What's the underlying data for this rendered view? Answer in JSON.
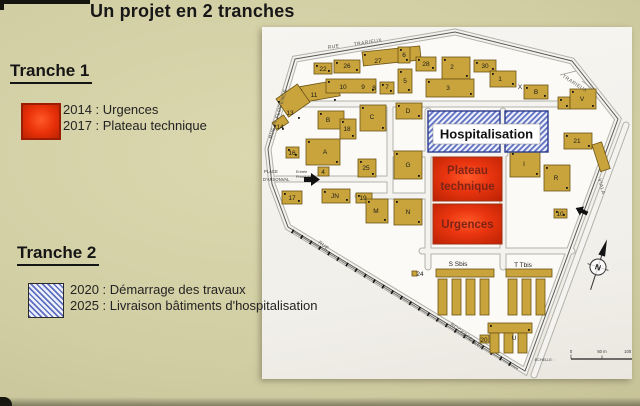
{
  "title": "Un projet en 2 tranches",
  "tranche1": {
    "heading": "Tranche 1",
    "items": [
      "2014 : Urgences",
      "2017 : Plateau technique"
    ]
  },
  "tranche2": {
    "heading": "Tranche 2",
    "items": [
      "2020 : Démarrage des travaux",
      "2025 : Livraison bâtiments d'hospitalisation"
    ]
  },
  "colors": {
    "phase1_red": "#e83008",
    "phase2_hatch_blue": "#5d6fc0",
    "building_gold": "#c9a33b",
    "board_khaki": "#d2cea4",
    "sheet_white": "#f3f2ee"
  },
  "map": {
    "zones": {
      "hospitalisation": "Hospitalisation",
      "plateau_line1": "Plateau",
      "plateau_line2": "technique",
      "urgences": "Urgences"
    },
    "place": {
      "line1": "PLACE",
      "line2": "D'ARSONVAL"
    },
    "entrance": {
      "line1": "Entrée",
      "line2": "Principale"
    },
    "compass_letter": "N",
    "scale": {
      "label": "ECHELLE :",
      "ticks": [
        "0",
        "50 m",
        "100 m"
      ]
    },
    "streets": [
      {
        "t": "RUE",
        "x": 66,
        "y": 22,
        "r": -9
      },
      {
        "t": "TRARIEUX",
        "x": 92,
        "y": 19,
        "r": -9
      },
      {
        "t": "TRARIEUX",
        "x": 300,
        "y": 50,
        "r": 33
      },
      {
        "t": "RUE Pr FLORENCE",
        "x": 10,
        "y": 112,
        "r": -73
      },
      {
        "t": "ROCKEFELLER",
        "x": 188,
        "y": 298,
        "r": 38
      },
      {
        "t": "RUE",
        "x": 56,
        "y": 216,
        "r": 38
      },
      {
        "t": "VIALA",
        "x": 336,
        "y": 152,
        "r": 75
      }
    ],
    "building_labels": [
      {
        "t": "22",
        "x": 61,
        "y": 44
      },
      {
        "t": "26",
        "x": 85,
        "y": 41
      },
      {
        "t": "27",
        "x": 116,
        "y": 36
      },
      {
        "t": "6",
        "x": 142,
        "y": 30
      },
      {
        "t": "28",
        "x": 164,
        "y": 39
      },
      {
        "t": "2",
        "x": 190,
        "y": 42
      },
      {
        "t": "30",
        "x": 223,
        "y": 41
      },
      {
        "t": "1",
        "x": 238,
        "y": 54
      },
      {
        "t": "X",
        "x": 258,
        "y": 62
      },
      {
        "t": "B",
        "x": 274,
        "y": 67
      },
      {
        "t": "3",
        "x": 186,
        "y": 63
      },
      {
        "t": "5",
        "x": 143,
        "y": 56
      },
      {
        "t": "7",
        "x": 125,
        "y": 62
      },
      {
        "t": "8",
        "x": 112,
        "y": 63
      },
      {
        "t": "9",
        "x": 101,
        "y": 62
      },
      {
        "t": "10",
        "x": 81,
        "y": 62
      },
      {
        "t": "11",
        "x": 52,
        "y": 70
      },
      {
        "t": "13",
        "x": 28,
        "y": 88
      },
      {
        "t": "14",
        "x": 18,
        "y": 102
      },
      {
        "t": "B",
        "x": 66,
        "y": 95
      },
      {
        "t": "18",
        "x": 85,
        "y": 104
      },
      {
        "t": "C",
        "x": 110,
        "y": 92
      },
      {
        "t": "D",
        "x": 146,
        "y": 86
      },
      {
        "t": "16",
        "x": 30,
        "y": 128
      },
      {
        "t": "A",
        "x": 63,
        "y": 127
      },
      {
        "t": "4",
        "x": 61,
        "y": 147
      },
      {
        "t": "25",
        "x": 104,
        "y": 143
      },
      {
        "t": "17",
        "x": 30,
        "y": 173
      },
      {
        "t": "JN",
        "x": 73,
        "y": 171
      },
      {
        "t": "19",
        "x": 101,
        "y": 173
      },
      {
        "t": "G",
        "x": 146,
        "y": 140
      },
      {
        "t": "M",
        "x": 114,
        "y": 186
      },
      {
        "t": "N",
        "x": 146,
        "y": 187
      },
      {
        "t": "I",
        "x": 262,
        "y": 139
      },
      {
        "t": "R",
        "x": 294,
        "y": 153
      },
      {
        "t": "21",
        "x": 315,
        "y": 116
      },
      {
        "t": "V",
        "x": 320,
        "y": 74
      },
      {
        "t": "24",
        "x": 158,
        "y": 249
      },
      {
        "t": "10",
        "x": 298,
        "y": 189
      },
      {
        "t": "20",
        "x": 222,
        "y": 315
      },
      {
        "t": "U",
        "x": 252,
        "y": 313
      },
      {
        "t": "S Sbis",
        "x": 196,
        "y": 239
      },
      {
        "t": "T Tbis",
        "x": 261,
        "y": 240
      }
    ],
    "buildings": [
      {
        "x": 52,
        "y": 36,
        "w": 18,
        "h": 11
      },
      {
        "x": 72,
        "y": 33,
        "w": 26,
        "h": 13
      },
      {
        "x": 100,
        "y": 25,
        "w": 58,
        "h": 14,
        "r": -6
      },
      {
        "x": 136,
        "y": 20,
        "w": 12,
        "h": 16
      },
      {
        "x": 154,
        "y": 30,
        "w": 20,
        "h": 14
      },
      {
        "x": 180,
        "y": 30,
        "w": 28,
        "h": 22
      },
      {
        "x": 212,
        "y": 33,
        "w": 22,
        "h": 12
      },
      {
        "x": 36,
        "y": 60,
        "w": 40,
        "h": 16,
        "r": -10
      },
      {
        "x": 64,
        "y": 52,
        "w": 50,
        "h": 14
      },
      {
        "x": 118,
        "y": 55,
        "w": 14,
        "h": 12
      },
      {
        "x": 136,
        "y": 42,
        "w": 14,
        "h": 24
      },
      {
        "x": 164,
        "y": 52,
        "w": 48,
        "h": 18
      },
      {
        "x": 228,
        "y": 44,
        "w": 26,
        "h": 16
      },
      {
        "x": 262,
        "y": 58,
        "w": 24,
        "h": 14
      },
      {
        "x": 296,
        "y": 70,
        "w": 12,
        "h": 12
      },
      {
        "x": 308,
        "y": 62,
        "w": 26,
        "h": 20
      },
      {
        "x": 14,
        "y": 72,
        "w": 26,
        "h": 22,
        "r": -35
      },
      {
        "x": 10,
        "y": 96,
        "w": 14,
        "h": 9,
        "r": -35
      },
      {
        "x": 56,
        "y": 84,
        "w": 26,
        "h": 18
      },
      {
        "x": 78,
        "y": 92,
        "w": 16,
        "h": 20
      },
      {
        "x": 98,
        "y": 78,
        "w": 26,
        "h": 26
      },
      {
        "x": 134,
        "y": 76,
        "w": 26,
        "h": 16
      },
      {
        "x": 24,
        "y": 120,
        "w": 13,
        "h": 11
      },
      {
        "x": 44,
        "y": 112,
        "w": 34,
        "h": 26
      },
      {
        "x": 56,
        "y": 140,
        "w": 11,
        "h": 9
      },
      {
        "x": 96,
        "y": 132,
        "w": 18,
        "h": 18
      },
      {
        "x": 20,
        "y": 164,
        "w": 20,
        "h": 13
      },
      {
        "x": 60,
        "y": 162,
        "w": 28,
        "h": 14
      },
      {
        "x": 94,
        "y": 166,
        "w": 16,
        "h": 10
      },
      {
        "x": 132,
        "y": 124,
        "w": 28,
        "h": 28
      },
      {
        "x": 104,
        "y": 172,
        "w": 22,
        "h": 24
      },
      {
        "x": 132,
        "y": 172,
        "w": 28,
        "h": 26
      },
      {
        "x": 248,
        "y": 124,
        "w": 30,
        "h": 26
      },
      {
        "x": 282,
        "y": 138,
        "w": 26,
        "h": 26
      },
      {
        "x": 302,
        "y": 106,
        "w": 28,
        "h": 16
      },
      {
        "x": 292,
        "y": 182,
        "w": 13,
        "h": 9
      },
      {
        "x": 330,
        "y": 118,
        "w": 10,
        "h": 28,
        "r": -18
      },
      {
        "x": 174,
        "y": 242,
        "w": 58,
        "h": 8
      },
      {
        "x": 176,
        "y": 252,
        "w": 9,
        "h": 36
      },
      {
        "x": 190,
        "y": 252,
        "w": 9,
        "h": 36
      },
      {
        "x": 204,
        "y": 252,
        "w": 9,
        "h": 36
      },
      {
        "x": 218,
        "y": 252,
        "w": 9,
        "h": 36
      },
      {
        "x": 244,
        "y": 242,
        "w": 46,
        "h": 8
      },
      {
        "x": 246,
        "y": 252,
        "w": 9,
        "h": 36
      },
      {
        "x": 260,
        "y": 252,
        "w": 9,
        "h": 36
      },
      {
        "x": 274,
        "y": 252,
        "w": 9,
        "h": 36
      },
      {
        "x": 226,
        "y": 296,
        "w": 44,
        "h": 10
      },
      {
        "x": 228,
        "y": 306,
        "w": 9,
        "h": 20
      },
      {
        "x": 242,
        "y": 306,
        "w": 9,
        "h": 20
      },
      {
        "x": 256,
        "y": 306,
        "w": 9,
        "h": 20
      },
      {
        "x": 218,
        "y": 308,
        "w": 9,
        "h": 8
      },
      {
        "x": 150,
        "y": 244,
        "w": 5,
        "h": 5
      }
    ]
  }
}
